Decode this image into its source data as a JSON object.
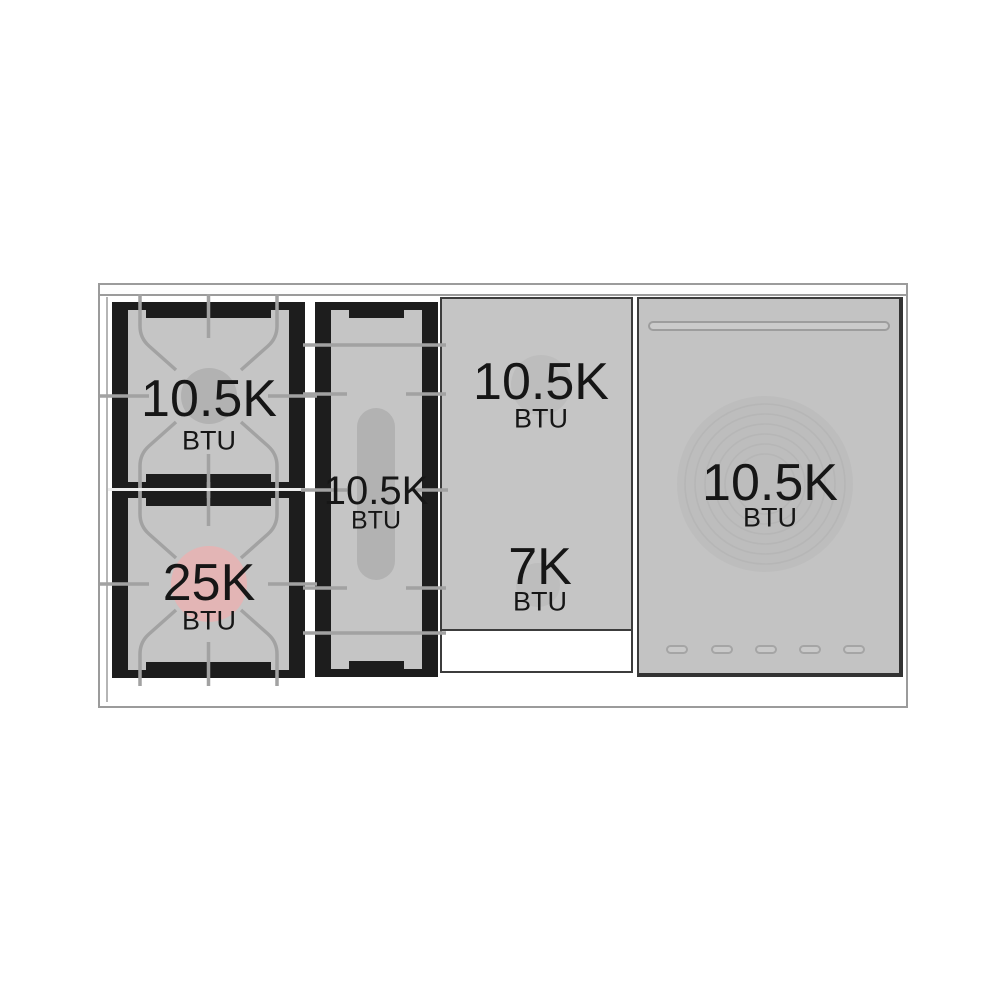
{
  "diagram": {
    "name": "range-cooktop-btu-diagram",
    "burners": {
      "left_top": {
        "value": "10.5K",
        "unit": "BTU"
      },
      "left_bottom": {
        "value": "25K",
        "unit": "BTU"
      },
      "griddle": {
        "value": "10.5K",
        "unit": "BTU"
      },
      "center_top": {
        "value": "10.5K",
        "unit": "BTU"
      },
      "center_bottom": {
        "value": "7K",
        "unit": "BTU"
      },
      "right_zone": {
        "value": "10.5K",
        "unit": "BTU"
      }
    },
    "colors": {
      "surface_gray": "#c5c5c5",
      "module_black": "#1d1d1d",
      "grate_line": "#a2a2a2",
      "burner_gray": "#b2b2b2",
      "burner_highlight_pink": "#e3b5b5",
      "panel_border_dark": "#3c3c3c",
      "outline_gray": "#9b9b9b",
      "text": "#161616"
    }
  }
}
